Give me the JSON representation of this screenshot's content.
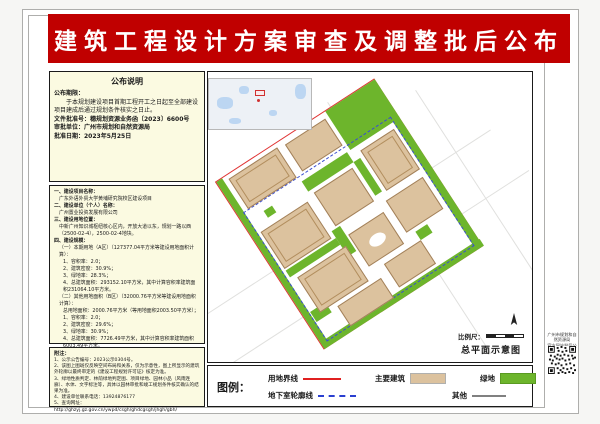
{
  "banner": {
    "title": "建筑工程设计方案审查及调整批后公布"
  },
  "notice": {
    "title": "公布说明",
    "lines": [
      {
        "cls": "b",
        "text": "公布期限："
      },
      {
        "cls": "n",
        "text": "　　于本规划建设项目首期工程开工之日起至全部建设项目建成后通过规划条件核实之日止。"
      },
      {
        "cls": "b",
        "text": "文件批准号：穗规划资源业务函〔2023〕6600号"
      },
      {
        "cls": "b",
        "text": "审批单位：广州市规划和自然资源局"
      },
      {
        "cls": "b",
        "text": "批准日期：2023年5月25日"
      }
    ]
  },
  "details": {
    "lines": [
      {
        "cls": "h",
        "text": "一、建设项目名称："
      },
      {
        "cls": "i",
        "text": "广东外语外贸大学黄埔研究院校区建设项目"
      },
      {
        "cls": "h",
        "text": "二、建设单位（个人）名称："
      },
      {
        "cls": "i",
        "text": "广州置业投资发展有限公司"
      },
      {
        "cls": "h",
        "text": "三、建设用地位置："
      },
      {
        "cls": "i",
        "text": "中新广州知识城枢纽核心区内，开放大道以东，规划一路以西（2500-02-4），2500-02-4地块。"
      },
      {
        "cls": "h",
        "text": "四、建设规模："
      },
      {
        "cls": "i",
        "text": "（一）本期用地（A区）（127377.04平方米等建设用地面积计算）："
      },
      {
        "cls": "i2",
        "text": "1、容积率：2.0；"
      },
      {
        "cls": "i2",
        "text": "2、建筑密度：30.9%；"
      },
      {
        "cls": "i2",
        "text": "3、绿地率：28.3%；"
      },
      {
        "cls": "i2",
        "text": "4、总建筑面积：293152.10平方米，其中计算容积率建筑面积231064.10平方米。"
      },
      {
        "cls": "i",
        "text": "（二）其他用地面积（B区）（32000.76平方米等建设用地面积计算）："
      },
      {
        "cls": "i2",
        "text": "总用地面积：2000.76平方米（等用地面积2003.50平方米）；"
      },
      {
        "cls": "i2",
        "text": "1、容积率：2.0；"
      },
      {
        "cls": "i2",
        "text": "2、建筑密度：29.6%；"
      },
      {
        "cls": "i2",
        "text": "3、绿地率：30.9%；"
      },
      {
        "cls": "i2",
        "text": "4、总建筑面积：7726.49平方米，其中计算容积率建筑面积6003.49平方米。"
      },
      {
        "cls": "h",
        "text": "五、车位配建情况："
      },
      {
        "cls": "i2",
        "text": "机动车泊车位：1990辆，其中地上40辆，地下1950辆；"
      },
      {
        "cls": "i2",
        "text": "非机动车车位：745辆，其中地上393辆，地下3471辆。"
      }
    ]
  },
  "notes": {
    "label": "附注：",
    "lines": [
      {
        "cls": "",
        "text": "1、公示公告编号：2023公示0304号。"
      },
      {
        "cls": "",
        "text": "2、该图上图斑仅反映空间布局和关系，仅为示意性，图上所显示的建筑外轮廓以最终审定的《建设工程规划许可证》核定为准。"
      },
      {
        "cls": "",
        "text": "3、绿地性质判定、林荫绿地判定图、项目绿地、园林小品（风雨连廊）、水体、文字标注等，具体以园林审批和竣工规划条件核实确认的结果为准。"
      },
      {
        "cls": "",
        "text": "4、建设单位联系电话：13924876177"
      },
      {
        "cls": "",
        "text": "5、查询网址：http://ghzyj.gz.gov.cn/ywpd/csgh/ghdcgsgh/jhgh/gbh/"
      }
    ]
  },
  "map": {
    "scale_label": "比例尺：",
    "caption": "总平面示意图"
  },
  "legend": {
    "title": "图例：",
    "items": [
      {
        "label": "用地界线",
        "symbol": "red-line"
      },
      {
        "label": "主要建筑",
        "symbol": "beige-swatch"
      },
      {
        "label": "绿地",
        "symbol": "green-swatch"
      },
      {
        "label": "地下室轮廓线",
        "symbol": "blue-dashed-line"
      },
      {
        "label": "其他",
        "symbol": "gray-line"
      }
    ]
  },
  "qr": {
    "caption_line1": "广州市规划和自然资源局",
    "caption_line2": "官方网站批后公布查询"
  },
  "colors": {
    "banner_red": "#c00000",
    "panel_bg": "#fbfae1",
    "building_fill": "#dcc29e",
    "green_fill": "#6db52c",
    "boundary_red": "#e03333",
    "underground_blue": "#3a4fd0",
    "water_blue": "#bcd6f2"
  }
}
